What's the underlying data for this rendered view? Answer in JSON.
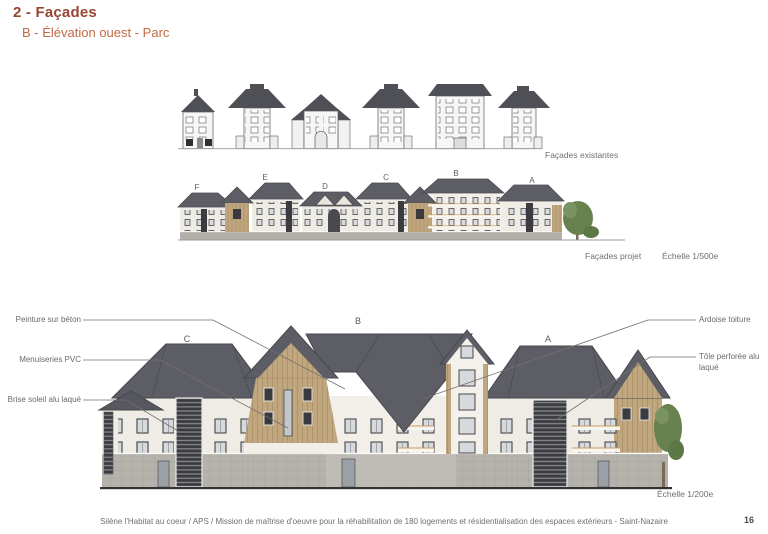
{
  "header": {
    "title": "2 - Façades",
    "subtitle": "B - Élévation ouest - Parc"
  },
  "existing": {
    "caption": "Façades existantes"
  },
  "project": {
    "caption": "Façades projet",
    "scale": "Échelle 1/500e",
    "letters": [
      "F",
      "E",
      "D",
      "C",
      "B",
      "A"
    ]
  },
  "detail": {
    "scale": "Échelle 1/200e",
    "letters": [
      "C",
      "B",
      "A"
    ]
  },
  "annotations": {
    "peinture": "Peinture sur béton",
    "menuiseries": "Menuiseries PVC",
    "brise": "Brise soleil alu laqué",
    "ardoise": "Ardoise toiture",
    "tole": "Tôle perforée alu laqué"
  },
  "footer": {
    "credit": "Silène l'Habitat au coeur / APS / Mission de maîtrise d'oeuvre pour la réhabilitation de 180 logements et résidentialisation des espaces extérieurs - Saint-Nazaire",
    "page_number": "16"
  },
  "colors": {
    "title": "#974633",
    "subtitle": "#c06a43",
    "roof_slate": "#5d5d66",
    "wall_cream": "#efece5",
    "wood_cladding": "#c1a77f",
    "base_tile_gray": "#b5b2ac",
    "annotation_gray": "#6a6a6a",
    "balcony_ochre": "#c89a5a",
    "tree_green": "#67824f"
  }
}
